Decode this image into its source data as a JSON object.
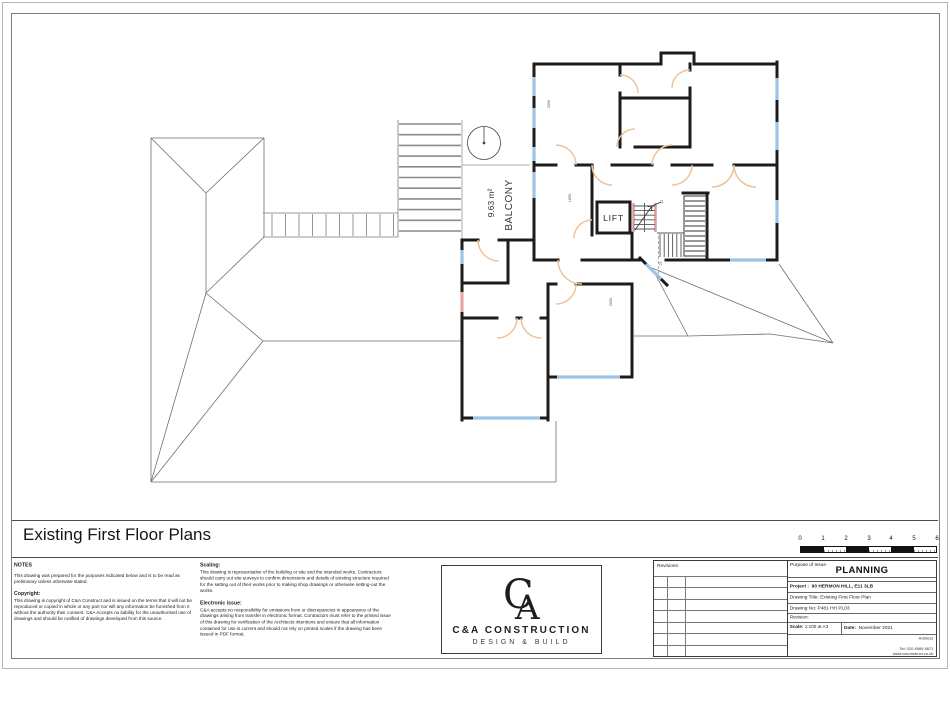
{
  "sheet_title": "Existing First Floor Plans",
  "plan": {
    "balcony_area": "9.63 m²",
    "balcony_label": "BALCONY",
    "lift_label": "LIFT",
    "dims": {
      "d1": "2000",
      "d2": "1650",
      "d3": "2000"
    },
    "stair": {
      "up_num": "12",
      "down_num": "13"
    }
  },
  "notes": {
    "heading": "NOTES",
    "p1": "This drawing was prepared for the purposes indicated below and is to be read as preliminary unless otherwise stated.",
    "copyright_heading": "Copyright:",
    "copyright_body": "This drawing is copyright of C&A Construct and is issued on the terms that it will not be reproduced or copied in whole or any part nor will any information be furnished from it without the authority their consent. C&A Accepts no liability for the unauthorised use of drawings and should be notified of drawings developed from this source."
  },
  "scaling": {
    "heading": "Scaling:",
    "body": "This drawing is representative of the building or site and the intended works. Contractors should carry out site surveys to confirm dimensions and details of existing structure required for the setting out of their works prior to making shop drawings or otherwise setting-out the works.",
    "electronic_heading": "Electronic issue:",
    "electronic_body": "C&A accepts no responsibility for omissions from or discrepancies in appearance of the drawings arising from transfer in electronic format. Contractors must refer to the printed issue of this drawing for verification of the Architects intentions and ensure that all information contained for use is current and should not rely on printed scales if the drawing has been issued in PDF format."
  },
  "logo": {
    "monogram_c": "C",
    "monogram_a": "A",
    "name": "C&A CONSTRUCTION",
    "tagline": "DESIGN & BUILD"
  },
  "scalebar": {
    "ticks": [
      "0",
      "1",
      "2",
      "3",
      "4",
      "5",
      "6"
    ]
  },
  "titleblock": {
    "revisions_label": "Revisions:",
    "purpose_label": "Purpose of Issue",
    "purpose_value": "PLANNING",
    "project_label": "Project :",
    "project_value": "90 HERMON HILL, E11 3LB",
    "drawing_title_label": "Drawing Title:",
    "drawing_title_value": "Existing First Floor Plan",
    "drawing_no_label": "Drawing No:",
    "drawing_no_value": "P481 HH PL03",
    "revision_label": "Revision:",
    "scale_label": "Scale:",
    "scale_value": "1:100 at A3",
    "date_label": "Date:",
    "date_value": "November 2021",
    "address_label": "Address",
    "tel": "Tel: 020 8989 8671",
    "web": "www.caconstruct.co.uk"
  },
  "colors": {
    "wall": "#1c1c1c",
    "window_blue": "#9dc3e6",
    "window_pink": "#e5a6a6",
    "door_arc": "#ecc39a",
    "stair_red": "#dd9c9c",
    "roof_line": "#6f6f6f"
  }
}
